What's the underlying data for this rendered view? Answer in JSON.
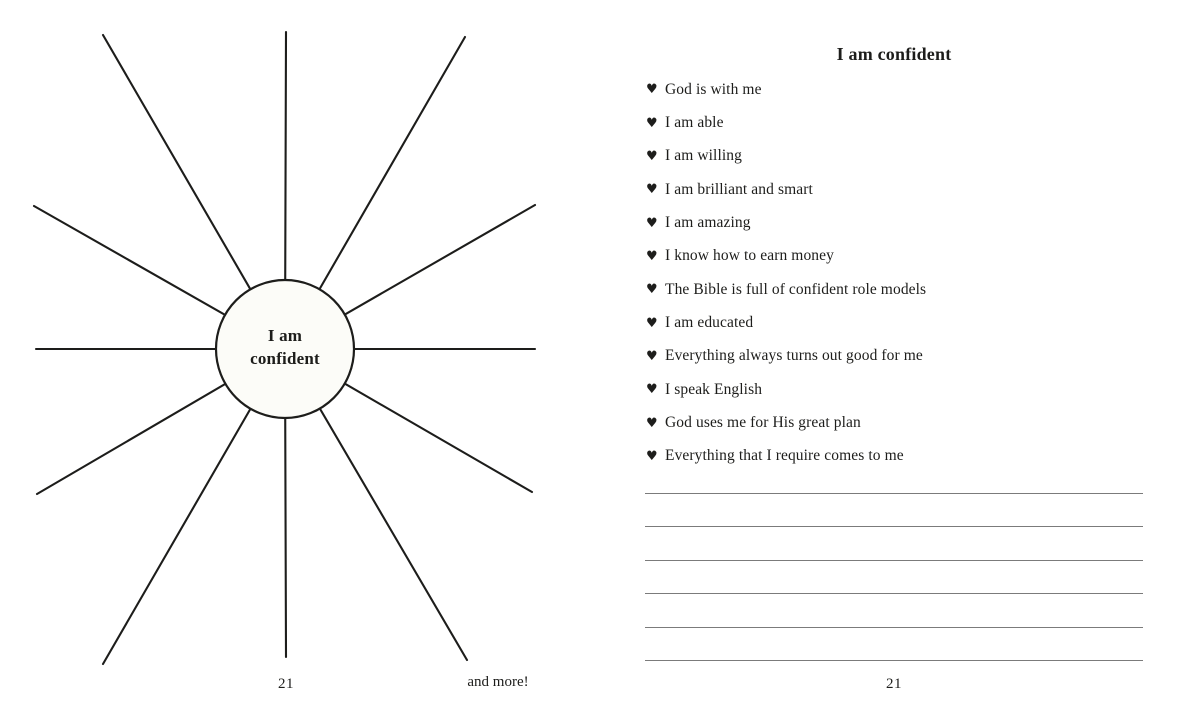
{
  "left_page": {
    "diagram": {
      "center_label_line1": "I am",
      "center_label_line2": "confident",
      "ray_count": 12
    },
    "page_number": "21",
    "footer_note": "and more!"
  },
  "right_page": {
    "title": "I am confident",
    "bullet_icon": "♥",
    "items": [
      "God is with me",
      "I am able",
      "I am willing",
      "I am brilliant and smart",
      "I am amazing",
      "I know how to earn money",
      "The Bible is full of confident role models",
      "I am educated",
      "Everything always turns out good for me",
      "I speak English",
      "God uses me for His great plan",
      "Everything that I require comes to me"
    ],
    "writing_lines_count": 6,
    "page_number": "21"
  },
  "colors": {
    "paper": "#ffffff",
    "ink": "#1d1d1b",
    "rule_gray": "#7b7b7b",
    "circle_fill": "#fcfcf8"
  }
}
